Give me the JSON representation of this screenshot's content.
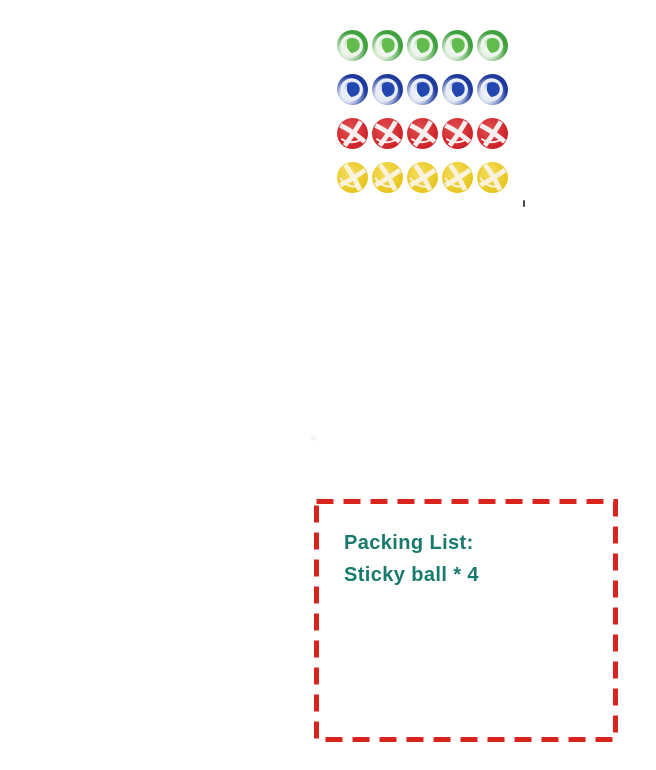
{
  "image": {
    "kind": "product-photo-collage",
    "background": "#ffffff"
  },
  "ball_grid": {
    "columns": 5,
    "rows": [
      {
        "color_name": "green",
        "style": "ring",
        "count": 5,
        "angle": 0,
        "main": "#3fa23f",
        "pale": "#dcecd8",
        "mid": "#62bb4d",
        "stripe": "#eef5ec"
      },
      {
        "color_name": "blue",
        "style": "ring",
        "count": 5,
        "angle": 0,
        "main": "#1f3a9d",
        "pale": "#dde4f2",
        "mid": "#2247b0",
        "stripe": "#e8edf6"
      },
      {
        "color_name": "red",
        "style": "cross",
        "count": 5,
        "angle": 0,
        "main": "#cd2127",
        "light": "#e25050",
        "stripe": "#f7eff0"
      },
      {
        "color_name": "yellow",
        "style": "cross",
        "count": 5,
        "angle": 25,
        "main": "#e8c51d",
        "light": "#f4de5e",
        "stripe": "#f9f3dd"
      }
    ]
  },
  "packing_list": {
    "title": "Packing List:",
    "item": "Sticky ball * 4",
    "text_color": "#177a6d",
    "border_color": "#d9241d",
    "dash_length": 17,
    "dash_gap": 10
  },
  "artifacts": {
    "stray_mark_color": "#4a4a4a"
  }
}
